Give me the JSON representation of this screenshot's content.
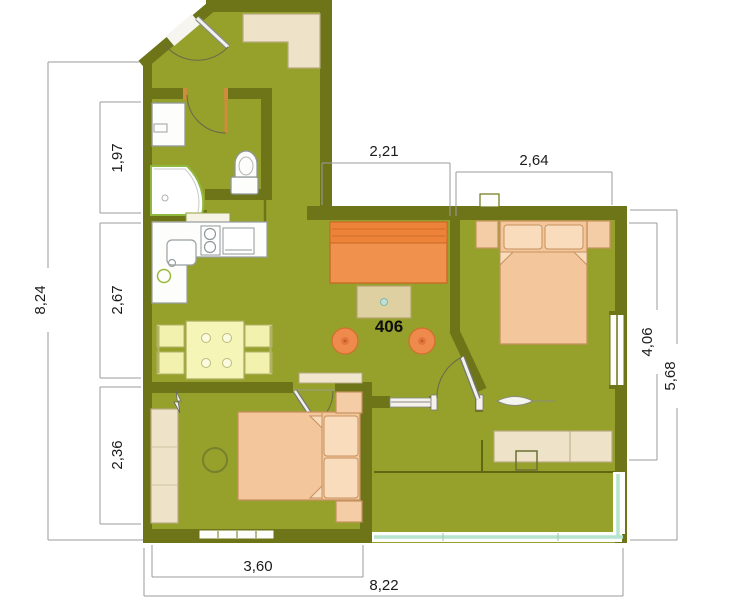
{
  "unit": {
    "number": "406"
  },
  "dimensions": {
    "left_total": "8,24",
    "left_bathroom": "1,97",
    "left_kitchen": "2,67",
    "left_bedroom2": "2,36",
    "top_hall": "2,21",
    "top_bedroom1": "2,64",
    "right_bedroom1": "4,06",
    "right_total": "5,68",
    "bottom_bedroom2": "3,60",
    "bottom_total": "8,22"
  },
  "colors": {
    "floor_olive": "#96a12c",
    "wall_dark_olive": "#6d7518",
    "sofa_orange": "#f0914e",
    "stool_orange": "#ef8a4d",
    "bed_peach": "#f3c69b",
    "furniture_beige": "#eee3c8",
    "table_yellow": "#f2f2ae",
    "balcony_glazing": "#b7e4cf"
  }
}
